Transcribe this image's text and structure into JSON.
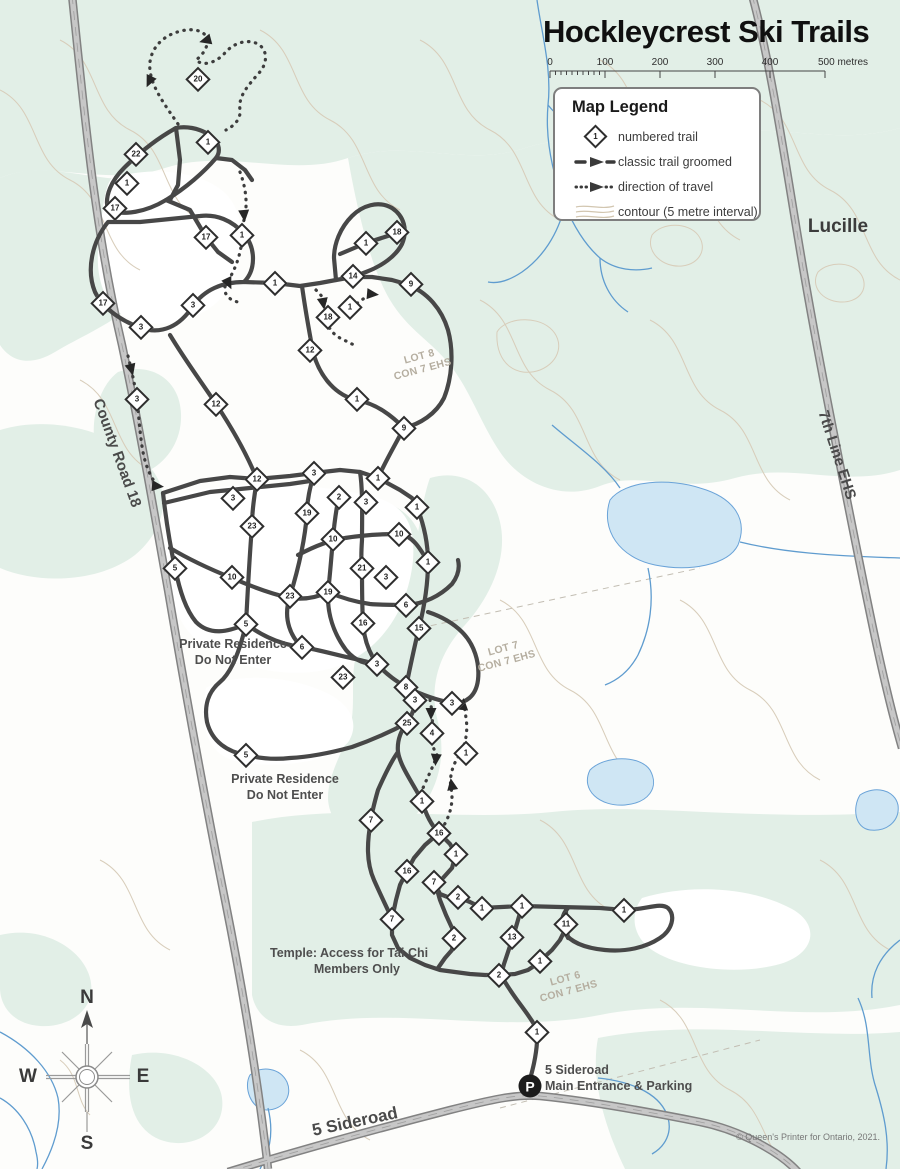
{
  "title": "Hockleycrest Ski Trails",
  "scale_bar": {
    "t0": "0",
    "t1": "100",
    "t2": "200",
    "t3": "300",
    "t4": "400",
    "end": "500 metres"
  },
  "legend": {
    "title": "Map Legend",
    "sample_number": "1",
    "items": [
      {
        "icon": "numbered-trail-icon",
        "label": "numbered trail"
      },
      {
        "icon": "classic-trail-icon",
        "label": "classic trail groomed"
      },
      {
        "icon": "direction-of-travel-icon",
        "label": "direction of travel"
      },
      {
        "icon": "contour-icon",
        "label": "contour (5 metre interval)"
      }
    ]
  },
  "roads": {
    "county_road": "County Road 18",
    "seventh_line": "7th Line EHS",
    "sideroad": "5 Sideroad"
  },
  "places": {
    "lucille": "Lucille"
  },
  "lots": {
    "lot8": {
      "line1": "LOT 8",
      "line2": "CON 7 EHS"
    },
    "lot7": {
      "line1": "LOT 7",
      "line2": "CON 7 EHS"
    },
    "lot6": {
      "line1": "LOT 6",
      "line2": "CON 7 EHS"
    }
  },
  "annotations": {
    "private1": {
      "line1": "Private Residence",
      "line2": "Do Not Enter"
    },
    "private2": {
      "line1": "Private Residence",
      "line2": "Do Not Enter"
    },
    "temple": {
      "line1": "Temple: Access for Tai Chi",
      "line2": "Members Only"
    }
  },
  "entrance": {
    "p": "P",
    "line1": "5 Sideroad",
    "line2": "Main Entrance & Parking"
  },
  "compass": {
    "n": "N",
    "e": "E",
    "s": "S",
    "w": "W"
  },
  "copyright": "© Queen's Printer for Ontario, 2021.",
  "colors": {
    "trail": "#474747",
    "forest": "#e2efe7",
    "contour": "#d8cdba",
    "water": "#5f9ccf",
    "road_fill": "#c7c7c7",
    "road_casing": "#828282"
  },
  "trail_markers": [
    {
      "n": "20",
      "x": 198,
      "y": 79
    },
    {
      "n": "22",
      "x": 136,
      "y": 154
    },
    {
      "n": "1",
      "x": 208,
      "y": 142
    },
    {
      "n": "1",
      "x": 127,
      "y": 183
    },
    {
      "n": "17",
      "x": 115,
      "y": 208
    },
    {
      "n": "17",
      "x": 206,
      "y": 237
    },
    {
      "n": "1",
      "x": 242,
      "y": 235
    },
    {
      "n": "17",
      "x": 103,
      "y": 303
    },
    {
      "n": "3",
      "x": 141,
      "y": 327
    },
    {
      "n": "3",
      "x": 193,
      "y": 305
    },
    {
      "n": "1",
      "x": 275,
      "y": 283
    },
    {
      "n": "18",
      "x": 397,
      "y": 232
    },
    {
      "n": "1",
      "x": 366,
      "y": 243
    },
    {
      "n": "14",
      "x": 353,
      "y": 276
    },
    {
      "n": "9",
      "x": 411,
      "y": 284
    },
    {
      "n": "18",
      "x": 328,
      "y": 317
    },
    {
      "n": "1",
      "x": 350,
      "y": 307
    },
    {
      "n": "12",
      "x": 310,
      "y": 350
    },
    {
      "n": "3",
      "x": 137,
      "y": 399
    },
    {
      "n": "12",
      "x": 216,
      "y": 404
    },
    {
      "n": "1",
      "x": 357,
      "y": 399
    },
    {
      "n": "9",
      "x": 404,
      "y": 428
    },
    {
      "n": "12",
      "x": 257,
      "y": 479
    },
    {
      "n": "3",
      "x": 314,
      "y": 473
    },
    {
      "n": "1",
      "x": 378,
      "y": 478
    },
    {
      "n": "3",
      "x": 233,
      "y": 498
    },
    {
      "n": "2",
      "x": 339,
      "y": 497
    },
    {
      "n": "3",
      "x": 366,
      "y": 502
    },
    {
      "n": "1",
      "x": 417,
      "y": 507
    },
    {
      "n": "19",
      "x": 307,
      "y": 513
    },
    {
      "n": "23",
      "x": 252,
      "y": 526
    },
    {
      "n": "10",
      "x": 333,
      "y": 539
    },
    {
      "n": "10",
      "x": 399,
      "y": 534
    },
    {
      "n": "1",
      "x": 428,
      "y": 562
    },
    {
      "n": "21",
      "x": 362,
      "y": 568
    },
    {
      "n": "3",
      "x": 386,
      "y": 577
    },
    {
      "n": "5",
      "x": 175,
      "y": 568
    },
    {
      "n": "10",
      "x": 232,
      "y": 577
    },
    {
      "n": "19",
      "x": 328,
      "y": 592
    },
    {
      "n": "23",
      "x": 290,
      "y": 596
    },
    {
      "n": "6",
      "x": 406,
      "y": 605
    },
    {
      "n": "16",
      "x": 363,
      "y": 623
    },
    {
      "n": "15",
      "x": 419,
      "y": 628
    },
    {
      "n": "5",
      "x": 246,
      "y": 624
    },
    {
      "n": "6",
      "x": 302,
      "y": 647
    },
    {
      "n": "3",
      "x": 377,
      "y": 664
    },
    {
      "n": "23",
      "x": 343,
      "y": 677
    },
    {
      "n": "8",
      "x": 406,
      "y": 687
    },
    {
      "n": "3",
      "x": 415,
      "y": 700
    },
    {
      "n": "3",
      "x": 452,
      "y": 703
    },
    {
      "n": "25",
      "x": 407,
      "y": 723
    },
    {
      "n": "4",
      "x": 432,
      "y": 733
    },
    {
      "n": "1",
      "x": 466,
      "y": 753
    },
    {
      "n": "5",
      "x": 246,
      "y": 755
    },
    {
      "n": "7",
      "x": 371,
      "y": 820
    },
    {
      "n": "1",
      "x": 422,
      "y": 801
    },
    {
      "n": "16",
      "x": 439,
      "y": 833
    },
    {
      "n": "1",
      "x": 456,
      "y": 854
    },
    {
      "n": "16",
      "x": 407,
      "y": 871
    },
    {
      "n": "7",
      "x": 434,
      "y": 882
    },
    {
      "n": "2",
      "x": 458,
      "y": 897
    },
    {
      "n": "1",
      "x": 482,
      "y": 908
    },
    {
      "n": "1",
      "x": 522,
      "y": 906
    },
    {
      "n": "7",
      "x": 392,
      "y": 919
    },
    {
      "n": "11",
      "x": 566,
      "y": 924
    },
    {
      "n": "1",
      "x": 624,
      "y": 910
    },
    {
      "n": "2",
      "x": 454,
      "y": 938
    },
    {
      "n": "13",
      "x": 512,
      "y": 937
    },
    {
      "n": "1",
      "x": 540,
      "y": 961
    },
    {
      "n": "2",
      "x": 499,
      "y": 975
    },
    {
      "n": "1",
      "x": 537,
      "y": 1032
    }
  ]
}
